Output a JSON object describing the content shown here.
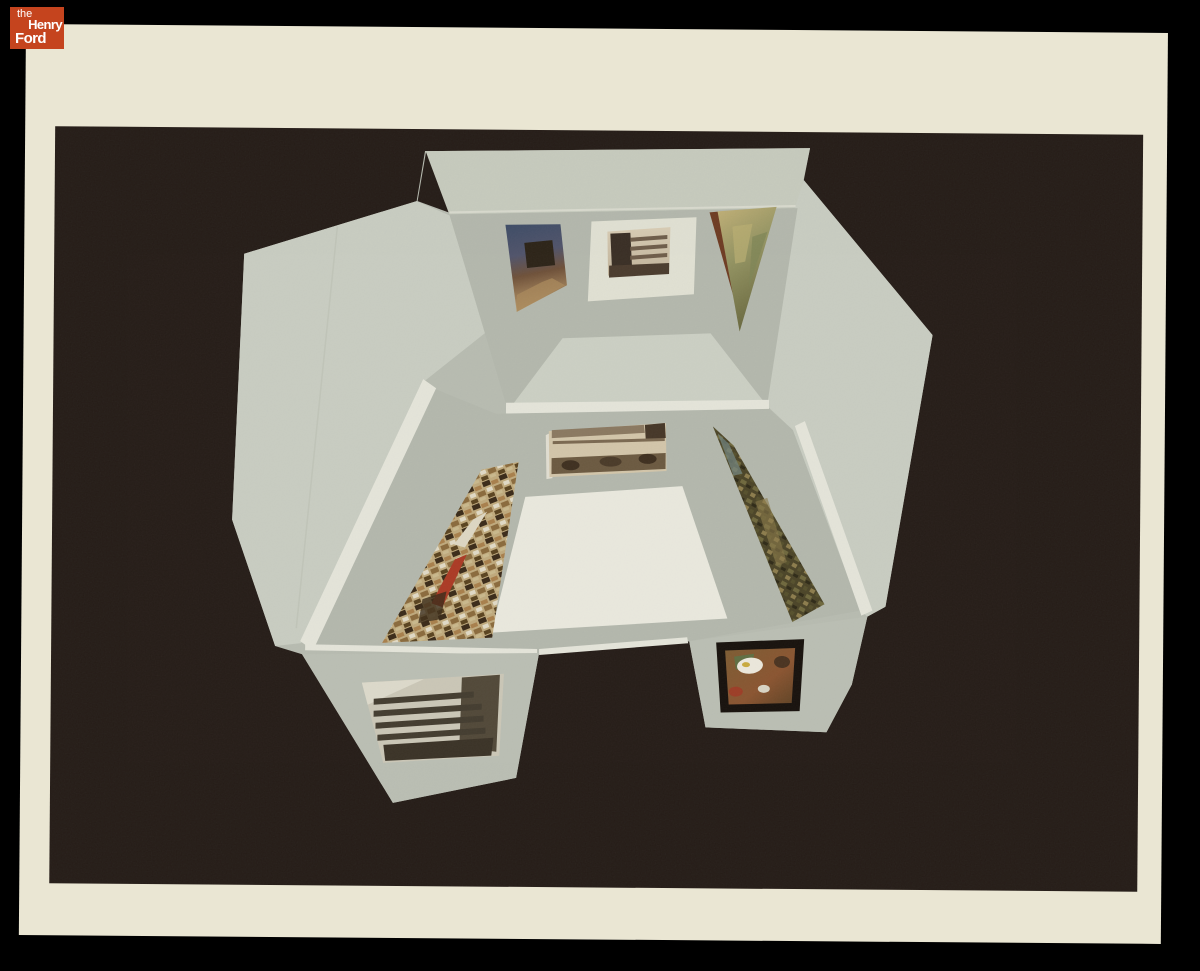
{
  "logo": {
    "the": "the",
    "henry": "Henry",
    "ford": "Ford"
  },
  "colors": {
    "page-bg": "#000000",
    "logo-orange": "#c5441e",
    "logo-text": "#ffffff",
    "paper-cream": "#eae6d3",
    "photo-dark": "#251c17",
    "model-gray": "#b7bbb0",
    "model-wall": "#b3b7ac",
    "model-light": "#c8ccc1",
    "model-top": "#c6cabd",
    "model-flap": "#babeb3",
    "floor-white": "#e9e8dd",
    "upper-floor": "#cbcfc3",
    "rim-white": "#e4e4d9"
  },
  "photo": {
    "subject": "Fold-out cardboard model of an exhibition gallery room with miniature artworks on its walls, photographed from above against a black background",
    "artworks": [
      {
        "id": "upper-left",
        "name": "painting with dark blue sky and dark animal figure on tan ground"
      },
      {
        "id": "upper-center",
        "name": "black-and-white photograph of a modern building on a white mat"
      },
      {
        "id": "upper-right",
        "name": "abstract painting in tan and green"
      },
      {
        "id": "middle-top",
        "name": "panoramic sepia photograph of a long building"
      },
      {
        "id": "middle-left",
        "name": "busy collage mural in browns, cream and red"
      },
      {
        "id": "middle-right",
        "name": "dark olive abstract painting"
      },
      {
        "id": "bottom-left",
        "name": "black-and-white photograph of a banded building facade"
      },
      {
        "id": "bottom-right",
        "name": "framed still life with white round plate"
      }
    ]
  }
}
